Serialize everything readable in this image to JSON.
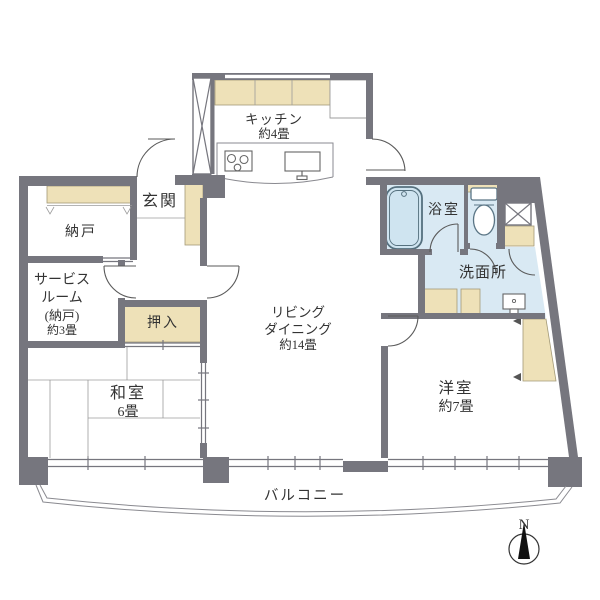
{
  "colors": {
    "wall": "#76767e",
    "cabinet": "#eee1b8",
    "wet_floor": "#d9e9f3",
    "tub_fill": "#cfe4f0",
    "line": "#8a8a90",
    "text": "#333333",
    "needle": "#111111"
  },
  "rooms": {
    "kitchen": {
      "label": "キッチン",
      "size": "約4畳"
    },
    "entrance": {
      "label": "玄関"
    },
    "storage": {
      "label": "納戸"
    },
    "service_room": {
      "label_line1": "サービス",
      "label_line2": "ルーム",
      "label_line3": "(納戸)",
      "label_line4": "約3畳"
    },
    "closet": {
      "label": "押入"
    },
    "japanese_room": {
      "label": "和室",
      "size": "6畳"
    },
    "living_dining": {
      "label_line1": "リビング",
      "label_line2": "ダイニング",
      "label_line3": "約14畳"
    },
    "bathroom": {
      "label": "浴室"
    },
    "washroom": {
      "label": "洗面所"
    },
    "western_room": {
      "label": "洋室",
      "size": "約7畳"
    },
    "balcony": {
      "label": "バルコニー"
    }
  },
  "compass": {
    "north_label": "N"
  }
}
